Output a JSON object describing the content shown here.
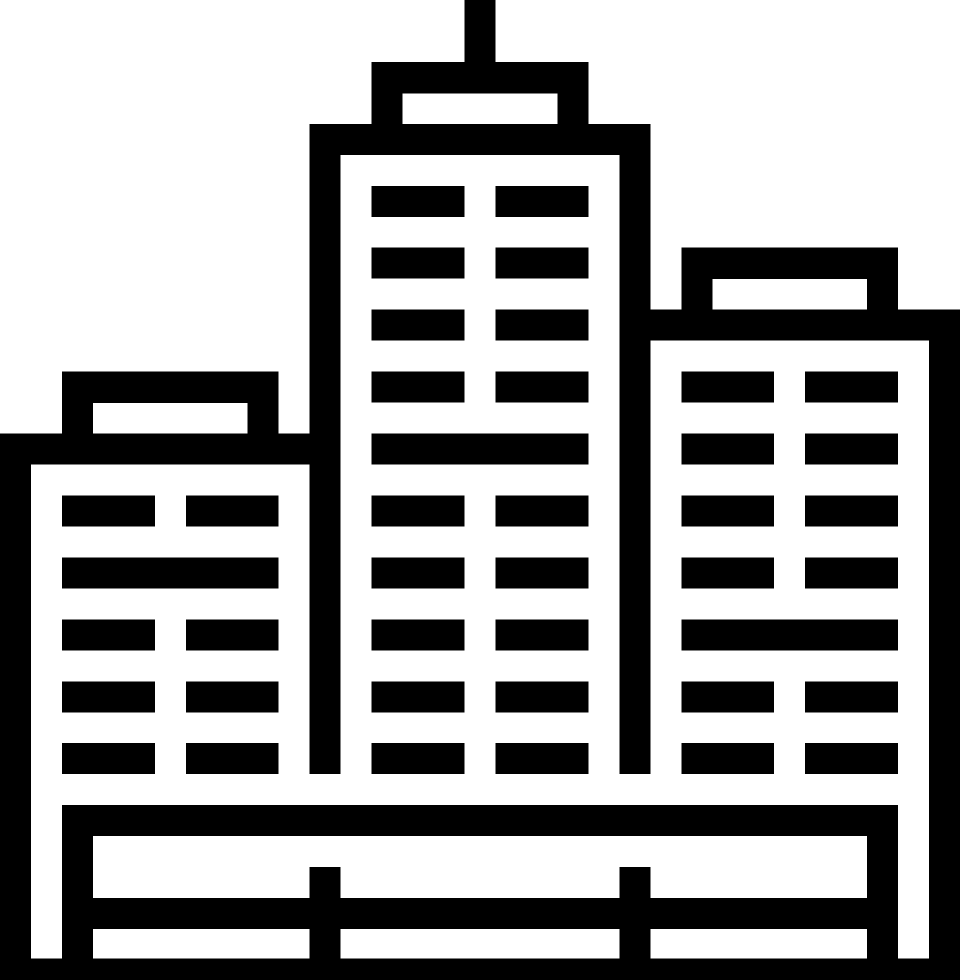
{
  "page": {
    "background_color": "#ffffff"
  },
  "icon": {
    "name": "city-buildings-icon",
    "description": "Black outline pictogram of a city skyline: three skyscrapers with rows of windows, rooftop caps, an antenna on the tallest center tower, and a fence-like base platform at the bottom",
    "fill_color": "#000000",
    "canvas": {
      "width": 960,
      "height": 980
    },
    "grid_unit": 30.97,
    "shapes": [
      [
        "antenna",
        464.5,
        0,
        31,
        62.5
      ],
      [
        "center-cap-top",
        371.6,
        61.9,
        216.8,
        31.5
      ],
      [
        "center-cap-side-left",
        371.6,
        92.9,
        31,
        31.5
      ],
      [
        "center-cap-side-right",
        557.4,
        92.9,
        31,
        31.5
      ],
      [
        "center-roof-band",
        309.7,
        123.9,
        340.7,
        31
      ],
      [
        "center-wall-left",
        309.7,
        154.8,
        31,
        619.4
      ],
      [
        "center-wall-right",
        619.4,
        154.8,
        31,
        619.4
      ],
      [
        "center-window",
        371.6,
        185.8,
        92.9,
        31
      ],
      [
        "center-window",
        495.5,
        185.8,
        92.9,
        31
      ],
      [
        "center-window",
        371.6,
        247.7,
        92.9,
        31
      ],
      [
        "center-window",
        495.5,
        247.7,
        92.9,
        31
      ],
      [
        "center-window",
        371.6,
        309.7,
        92.9,
        31
      ],
      [
        "center-window",
        495.5,
        309.7,
        92.9,
        31
      ],
      [
        "center-window",
        371.6,
        371.6,
        92.9,
        31
      ],
      [
        "center-window",
        495.5,
        371.6,
        92.9,
        31
      ],
      [
        "center-full-floor",
        371.6,
        433.5,
        216.8,
        31
      ],
      [
        "center-window",
        371.6,
        495.5,
        92.9,
        31
      ],
      [
        "center-window",
        495.5,
        495.5,
        92.9,
        31
      ],
      [
        "center-window",
        371.6,
        557.4,
        92.9,
        31
      ],
      [
        "center-window",
        495.5,
        557.4,
        92.9,
        31
      ],
      [
        "center-window",
        371.6,
        619.4,
        92.9,
        31
      ],
      [
        "center-window",
        495.5,
        619.4,
        92.9,
        31
      ],
      [
        "center-window",
        371.6,
        681.3,
        92.9,
        31
      ],
      [
        "center-window",
        495.5,
        681.3,
        92.9,
        31
      ],
      [
        "center-window",
        371.6,
        743.2,
        92.9,
        31
      ],
      [
        "center-window",
        495.5,
        743.2,
        92.9,
        31
      ],
      [
        "left-cap-top",
        61.9,
        371.6,
        216.8,
        31.5
      ],
      [
        "left-cap-side-left",
        61.9,
        402.6,
        31,
        31.5
      ],
      [
        "left-cap-side-right",
        247.7,
        402.6,
        31,
        31.5
      ],
      [
        "left-roof-band",
        0,
        433.5,
        309.7,
        31
      ],
      [
        "left-wall-outer",
        0,
        464.5,
        31,
        515.5
      ],
      [
        "left-window",
        61.9,
        495.5,
        92.9,
        31
      ],
      [
        "left-window",
        185.8,
        495.5,
        92.9,
        31
      ],
      [
        "left-full-floor",
        61.9,
        557.4,
        216.8,
        31
      ],
      [
        "left-window",
        61.9,
        619.4,
        92.9,
        31
      ],
      [
        "left-window",
        185.8,
        619.4,
        92.9,
        31
      ],
      [
        "left-window",
        61.9,
        681.3,
        92.9,
        31
      ],
      [
        "left-window",
        185.8,
        681.3,
        92.9,
        31
      ],
      [
        "left-window",
        61.9,
        743.2,
        92.9,
        31
      ],
      [
        "left-window",
        185.8,
        743.2,
        92.9,
        31
      ],
      [
        "right-cap-top",
        681.3,
        247.7,
        216.8,
        31.5
      ],
      [
        "right-cap-side-left",
        681.3,
        278.7,
        31,
        31.5
      ],
      [
        "right-cap-side-right",
        867.1,
        278.7,
        31,
        31.5
      ],
      [
        "right-roof-band",
        650.3,
        309.7,
        309.7,
        31
      ],
      [
        "right-wall-outer",
        929,
        340.6,
        31,
        639.4
      ],
      [
        "right-window",
        681.3,
        371.6,
        92.9,
        31
      ],
      [
        "right-window",
        805.2,
        371.6,
        92.9,
        31
      ],
      [
        "right-window",
        681.3,
        433.5,
        92.9,
        31
      ],
      [
        "right-window",
        805.2,
        433.5,
        92.9,
        31
      ],
      [
        "right-window",
        681.3,
        495.5,
        92.9,
        31
      ],
      [
        "right-window",
        805.2,
        495.5,
        92.9,
        31
      ],
      [
        "right-window",
        681.3,
        557.4,
        92.9,
        31
      ],
      [
        "right-window",
        805.2,
        557.4,
        92.9,
        31
      ],
      [
        "right-full-floor",
        681.3,
        619.4,
        216.8,
        31
      ],
      [
        "right-window",
        681.3,
        681.3,
        92.9,
        31
      ],
      [
        "right-window",
        805.2,
        681.3,
        92.9,
        31
      ],
      [
        "right-window",
        681.3,
        743.2,
        92.9,
        31
      ],
      [
        "right-window",
        805.2,
        743.2,
        92.9,
        31
      ],
      [
        "base-top-rail",
        61.9,
        805.2,
        836.2,
        31
      ],
      [
        "base-post-left",
        61.9,
        836.1,
        31,
        124
      ],
      [
        "base-post-right",
        867.1,
        836.1,
        31,
        124
      ],
      [
        "base-post-mid-left",
        309.7,
        867.1,
        31,
        93
      ],
      [
        "base-post-mid-right",
        619.4,
        867.1,
        31,
        93
      ],
      [
        "base-mid-rail",
        92.9,
        898.1,
        774.2,
        31
      ],
      [
        "base-ground-band",
        0,
        958.5,
        960,
        21.5
      ]
    ]
  }
}
